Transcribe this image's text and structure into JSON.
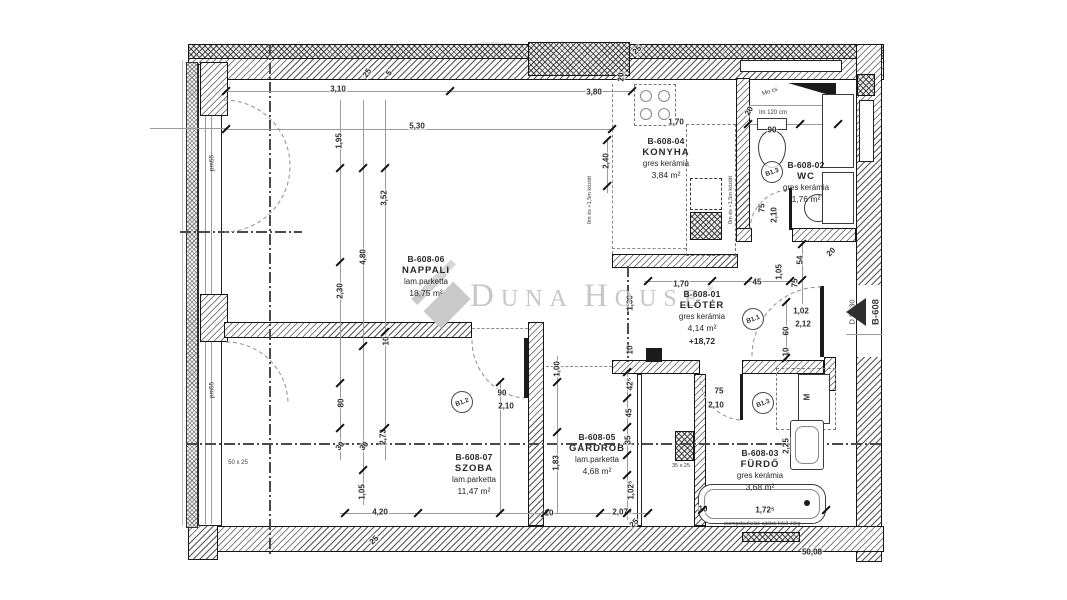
{
  "watermark": {
    "l1": "D",
    "l1r": "UNA",
    "l2": "H",
    "l2r": "OUSE",
    "reg": "®"
  },
  "rooms": [
    {
      "id": "B-608-04",
      "name": "KONYHA",
      "floor": "gres kerámia",
      "area": "3,84 m²",
      "x": 666,
      "y": 136
    },
    {
      "id": "B-608-06",
      "name": "NAPPALI",
      "floor": "lam.parketta",
      "area": "18,75 m²",
      "x": 426,
      "y": 254
    },
    {
      "id": "B-608-01",
      "name": "ELŐTÉR",
      "floor": "gres kerámia",
      "area": "4,14 m²",
      "level": "+18,72",
      "x": 702,
      "y": 289
    },
    {
      "id": "B-608-02",
      "name": "WC",
      "floor": "gres kerámia",
      "area": "1,76 m²",
      "x": 806,
      "y": 160
    },
    {
      "id": "B-608-05",
      "name": "GARDRÓB",
      "floor": "lam.parketta",
      "area": "4,68 m²",
      "x": 597,
      "y": 432
    },
    {
      "id": "B-608-07",
      "name": "SZOBA",
      "floor": "lam.parketta",
      "area": "11,47 m²",
      "x": 474,
      "y": 452
    },
    {
      "id": "B-608-03",
      "name": "FÜRDŐ",
      "floor": "gres kerámia",
      "area": "3,68 m²",
      "x": 760,
      "y": 448
    }
  ],
  "door_tags": [
    {
      "t": "B1.1",
      "x": 752,
      "y": 318
    },
    {
      "t": "B1.2",
      "x": 461,
      "y": 401
    },
    {
      "t": "B1.3",
      "x": 771,
      "y": 171
    },
    {
      "t": "B1.3",
      "x": 762,
      "y": 402
    }
  ],
  "dimensions": [
    {
      "t": "3,10",
      "x": 338,
      "y": 89,
      "r": 0
    },
    {
      "t": "25",
      "x": 367,
      "y": 73,
      "r": -55
    },
    {
      "t": "5",
      "x": 389,
      "y": 73,
      "r": -55
    },
    {
      "t": "3,80",
      "x": 594,
      "y": 92,
      "r": 0
    },
    {
      "t": "5,30",
      "x": 417,
      "y": 126,
      "r": 0
    },
    {
      "t": "1,95",
      "x": 339,
      "y": 141,
      "r": -90
    },
    {
      "t": "25",
      "x": 637,
      "y": 50,
      "r": -45
    },
    {
      "t": "20",
      "x": 621,
      "y": 77,
      "r": -90
    },
    {
      "t": "1,70",
      "x": 676,
      "y": 122,
      "r": 0
    },
    {
      "t": "2,40",
      "x": 606,
      "y": 161,
      "r": -90
    },
    {
      "t": "3,52",
      "x": 384,
      "y": 198,
      "r": -90
    },
    {
      "t": "4,80",
      "x": 363,
      "y": 257,
      "r": -90
    },
    {
      "t": "2,30",
      "x": 340,
      "y": 291,
      "r": -90
    },
    {
      "t": "90",
      "x": 772,
      "y": 130,
      "r": 0
    },
    {
      "t": "20",
      "x": 749,
      "y": 111,
      "r": -60
    },
    {
      "t": "10",
      "x": 386,
      "y": 341,
      "r": -90
    },
    {
      "t": "10",
      "x": 630,
      "y": 350,
      "r": -90
    },
    {
      "t": "1,30",
      "x": 630,
      "y": 303,
      "r": -90
    },
    {
      "t": "1,70",
      "x": 681,
      "y": 284,
      "r": 0
    },
    {
      "t": "45",
      "x": 757,
      "y": 282,
      "r": 0
    },
    {
      "t": "1,05",
      "x": 779,
      "y": 272,
      "r": -90
    },
    {
      "t": "54",
      "x": 800,
      "y": 260,
      "r": -90
    },
    {
      "t": "20",
      "x": 831,
      "y": 252,
      "r": -45
    },
    {
      "t": "75",
      "x": 795,
      "y": 283,
      "r": -90
    },
    {
      "t": "1,02",
      "x": 801,
      "y": 311,
      "r": 0
    },
    {
      "t": "2,12",
      "x": 803,
      "y": 324,
      "r": 0
    },
    {
      "t": "60",
      "x": 786,
      "y": 331,
      "r": -90
    },
    {
      "t": "10",
      "x": 786,
      "y": 352,
      "r": -90
    },
    {
      "t": "75",
      "x": 762,
      "y": 208,
      "r": -90
    },
    {
      "t": "2,10",
      "x": 774,
      "y": 215,
      "r": -90
    },
    {
      "t": "90",
      "x": 502,
      "y": 393,
      "r": 0
    },
    {
      "t": "2,10",
      "x": 506,
      "y": 406,
      "r": 0
    },
    {
      "t": "75",
      "x": 719,
      "y": 391,
      "r": 0
    },
    {
      "t": "2,10",
      "x": 716,
      "y": 405,
      "r": 0
    },
    {
      "t": "80",
      "x": 341,
      "y": 403,
      "r": -90
    },
    {
      "t": "30",
      "x": 340,
      "y": 446,
      "r": -50
    },
    {
      "t": "30",
      "x": 364,
      "y": 446,
      "r": -50
    },
    {
      "t": "2,73",
      "x": 383,
      "y": 437,
      "r": -90
    },
    {
      "t": "1,05",
      "x": 362,
      "y": 492,
      "r": -90
    },
    {
      "t": "4,20",
      "x": 380,
      "y": 512,
      "r": 0
    },
    {
      "t": "10",
      "x": 549,
      "y": 513,
      "r": 0
    },
    {
      "t": "1,83",
      "x": 556,
      "y": 463,
      "r": -90
    },
    {
      "t": "1,00",
      "x": 557,
      "y": 369,
      "r": -90
    },
    {
      "t": "42⁵",
      "x": 630,
      "y": 384,
      "r": -90
    },
    {
      "t": "45",
      "x": 629,
      "y": 413,
      "r": -90
    },
    {
      "t": "35",
      "x": 628,
      "y": 440,
      "r": -90
    },
    {
      "t": "1,02⁵",
      "x": 631,
      "y": 490,
      "r": -90
    },
    {
      "t": "2,07⁵",
      "x": 622,
      "y": 512,
      "r": 0
    },
    {
      "t": "25",
      "x": 634,
      "y": 523,
      "r": -45
    },
    {
      "t": "25",
      "x": 374,
      "y": 540,
      "r": -45
    },
    {
      "t": "2,25",
      "x": 786,
      "y": 446,
      "r": -90
    },
    {
      "t": "1,72⁵",
      "x": 765,
      "y": 510,
      "r": 0
    },
    {
      "t": "10",
      "x": 703,
      "y": 509,
      "r": 0
    },
    {
      "t": "50,08",
      "x": 812,
      "y": 552,
      "r": 0
    }
  ],
  "annotations": [
    {
      "t": "pm55",
      "x": 212,
      "y": 163,
      "r": -90,
      "s": 6.5
    },
    {
      "t": "pm55",
      "x": 212,
      "y": 390,
      "r": -90,
      "s": 6.5
    },
    {
      "t": "lm 120 cm",
      "x": 773,
      "y": 113,
      "r": 0,
      "s": 6
    },
    {
      "t": "Mo cs",
      "x": 770,
      "y": 92,
      "r": -18,
      "s": 6
    },
    {
      "t": "50 x 25",
      "x": 238,
      "y": 463,
      "r": 0,
      "s": 6
    },
    {
      "t": "35 x 25",
      "x": 681,
      "y": 466,
      "r": 0,
      "s": 5.5
    },
    {
      "t": "0m és +1,5m között",
      "x": 731,
      "y": 200,
      "r": -90,
      "s": 5.5
    },
    {
      "t": "0m és +1,5m között",
      "x": 590,
      "y": 200,
      "r": -90,
      "s": 5.5
    },
    {
      "t": "M",
      "x": 807,
      "y": 397,
      "r": -90,
      "s": 8,
      "b": 1
    },
    {
      "t": "csempeburkolat: ajtótok felső éléig",
      "x": 762,
      "y": 524,
      "r": 0,
      "s": 5
    },
    {
      "t": "D EL30",
      "x": 852,
      "y": 312,
      "r": -90,
      "s": 7.5
    },
    {
      "t": "B-608",
      "x": 876,
      "y": 312,
      "r": -90,
      "s": 9.5,
      "b": 1
    }
  ],
  "ticks": [
    [
      226,
      91
    ],
    [
      450,
      91
    ],
    [
      632,
      91
    ],
    [
      226,
      129
    ],
    [
      612,
      129
    ],
    [
      340,
      168
    ],
    [
      340,
      262
    ],
    [
      340,
      383
    ],
    [
      340,
      428
    ],
    [
      363,
      168
    ],
    [
      363,
      346
    ],
    [
      363,
      470
    ],
    [
      385,
      168
    ],
    [
      385,
      332
    ],
    [
      385,
      428
    ],
    [
      500,
      382
    ],
    [
      500,
      513
    ],
    [
      557,
      382
    ],
    [
      557,
      432
    ],
    [
      627,
      372
    ],
    [
      627,
      398
    ],
    [
      627,
      427
    ],
    [
      627,
      455
    ],
    [
      627,
      475
    ],
    [
      627,
      513
    ],
    [
      345,
      513
    ],
    [
      418,
      513
    ],
    [
      545,
      513
    ],
    [
      600,
      513
    ],
    [
      648,
      513
    ],
    [
      648,
      281
    ],
    [
      712,
      281
    ],
    [
      748,
      281
    ],
    [
      790,
      281
    ],
    [
      786,
      302
    ],
    [
      786,
      358
    ],
    [
      802,
      244
    ],
    [
      802,
      280
    ],
    [
      748,
      124
    ],
    [
      800,
      124
    ],
    [
      838,
      124
    ],
    [
      702,
      510
    ],
    [
      826,
      510
    ],
    [
      607,
      140
    ],
    [
      607,
      186
    ]
  ],
  "colors": {
    "wall": "#161616",
    "dim_text": "#2e2e2e",
    "watermark": "#c7c7c7"
  }
}
